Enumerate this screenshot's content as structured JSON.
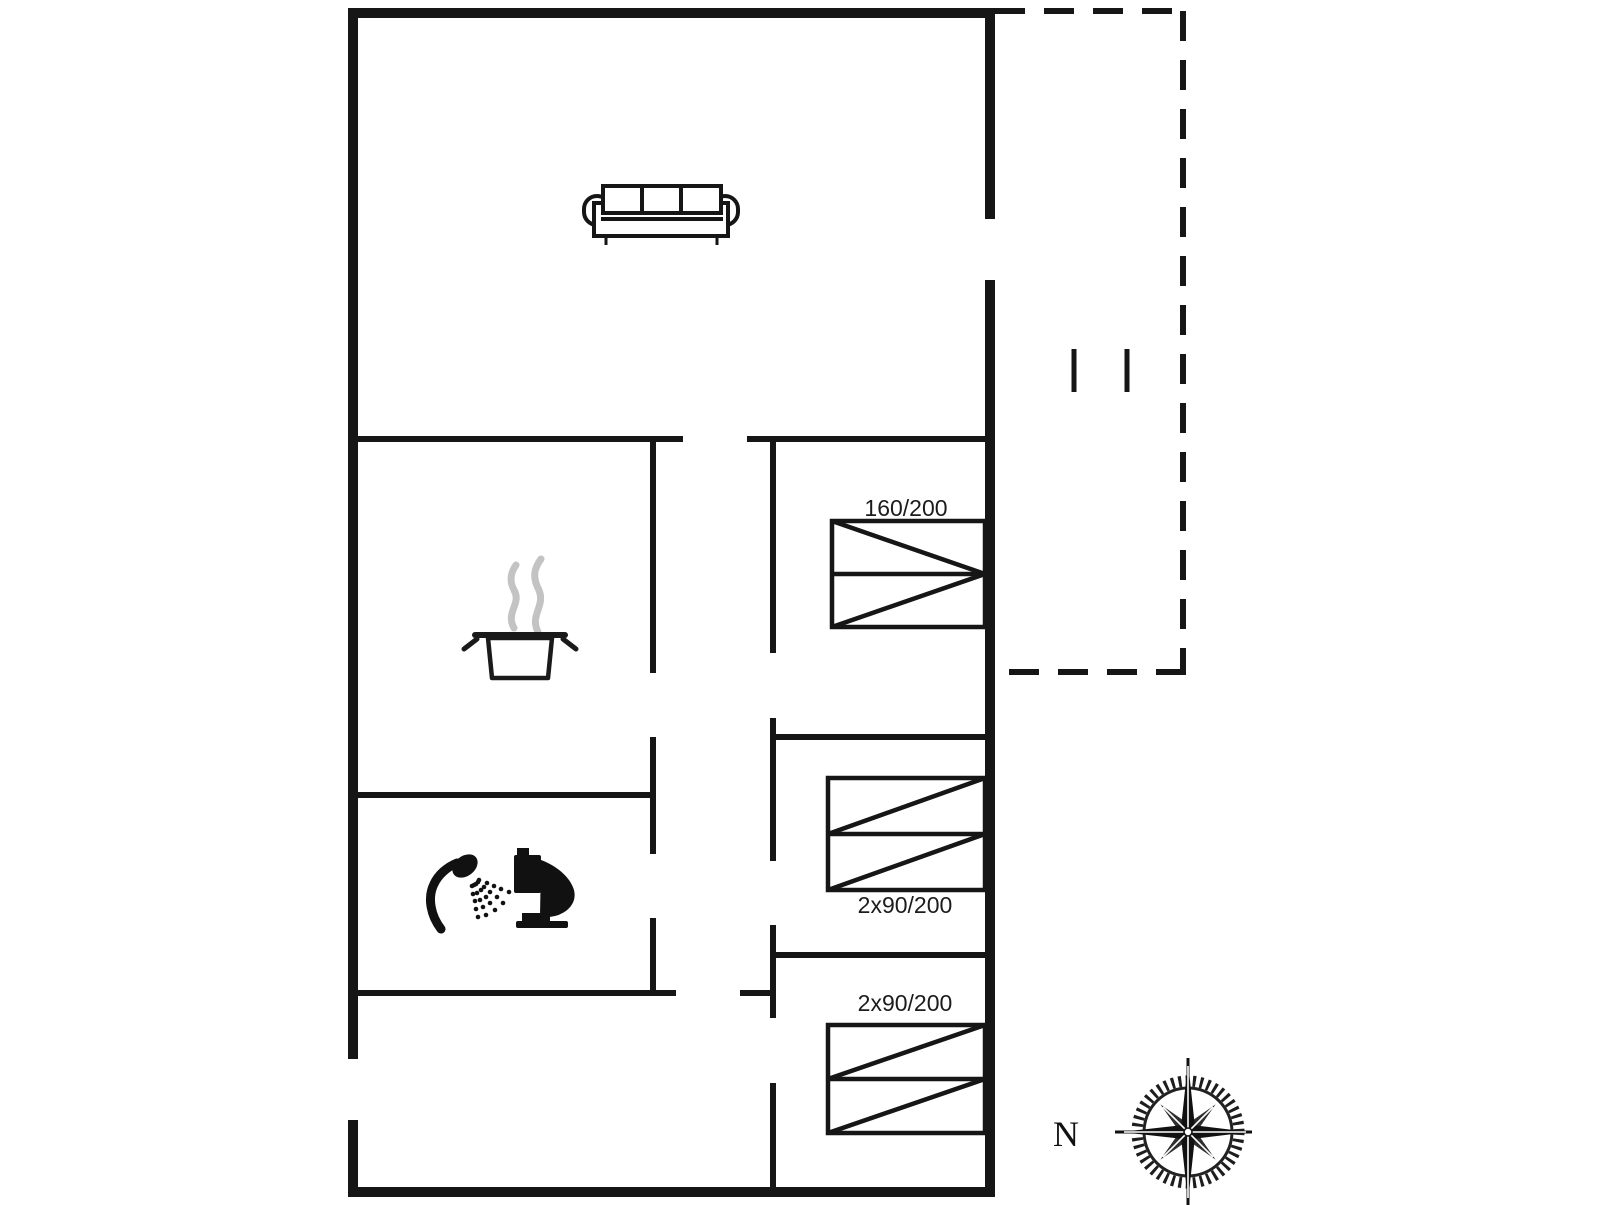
{
  "plan": {
    "type": "floor-plan",
    "labels": {
      "bed_double": "160/200",
      "bed_twin_middle": "2x90/200",
      "bed_twin_bottom": "2x90/200",
      "compass_north": "N"
    },
    "colors": {
      "walls": "#161616",
      "steam": "#c3c3c3",
      "background": "#ffffff"
    },
    "icons": [
      "sofa-icon",
      "cooking-pot-icon",
      "steam-icon",
      "shower-icon",
      "toilet-icon",
      "compass-rose-icon",
      "terrace-door-marks"
    ]
  }
}
